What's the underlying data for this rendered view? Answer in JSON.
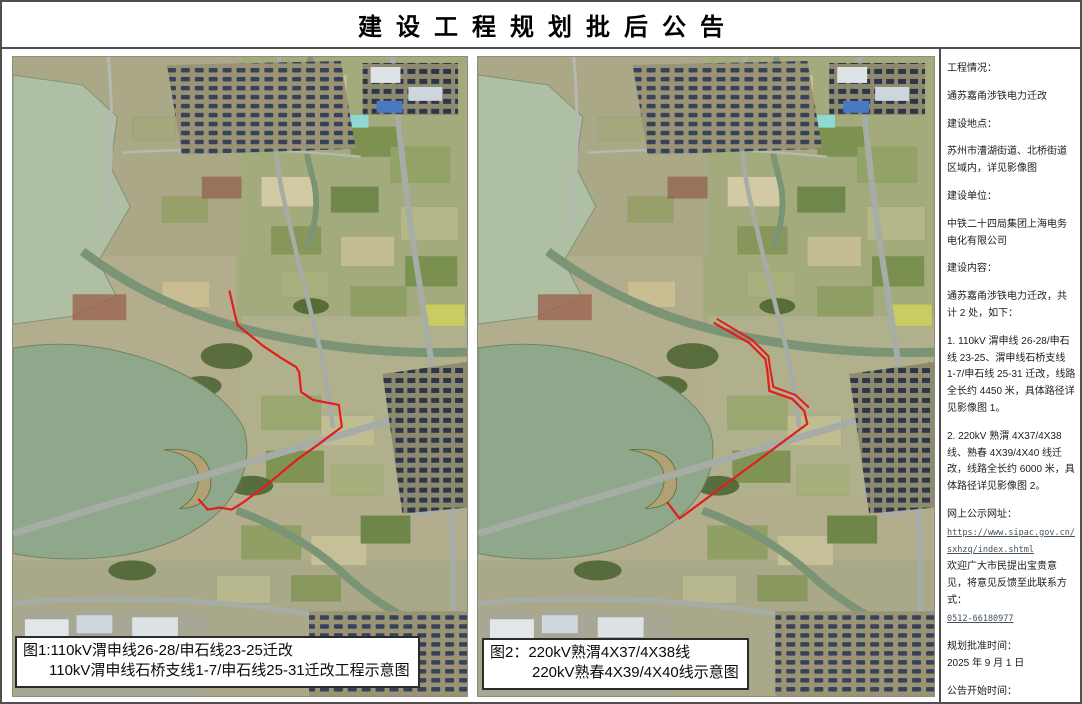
{
  "page": {
    "title": "建设工程规划批后公告"
  },
  "sidebar": {
    "items": [
      {
        "text": "工程情况："
      },
      {
        "text": "通苏嘉甬涉铁电力迁改"
      },
      {
        "text": "建设地点："
      },
      {
        "text": "苏州市漕湖街道、北桥街道区域内，详见影像图"
      },
      {
        "text": "建设单位："
      },
      {
        "text": "中铁二十四局集团上海电务电化有限公司"
      },
      {
        "text": "建设内容："
      },
      {
        "text": "通苏嘉甬涉铁电力迁改，共计 2 处，如下："
      },
      {
        "text": "1.  110kV 渭申线 26-28/申石线 23-25、渭申线石桥支线 1-7/申石线 25-31 迁改，线路全长约 4450 米，具体路径详见影像图 1。"
      },
      {
        "text": "2.  220kV 熟渭 4X37/4X38 线、熟春 4X39/4X40 线迁改，线路全长约 6000 米，具体路径详见影像图 2。"
      },
      {
        "text": "网上公示网址："
      },
      {
        "text": "https://www.sipac.gov.cn/sxhzq/index.shtml"
      },
      {
        "text": "欢迎广大市民提出宝贵意见，将意见反馈至此联系方式："
      },
      {
        "text": "0512-66180977"
      },
      {
        "text": "规划批准时间："
      },
      {
        "text": "2025 年 9 月 1 日"
      },
      {
        "text": "公告开始时间："
      },
      {
        "text": "2025 年 9 月 3 日"
      }
    ]
  },
  "maps": {
    "left": {
      "caption_line1": "图1:110kV渭申线26-28/申石线23-25迁改",
      "caption_line2": "110kV渭申线石桥支线1-7/申石线25-31迁改工程示意图"
    },
    "right": {
      "caption_line1": "图2：220kV熟渭4X37/4X38线",
      "caption_line2": "220kV熟春4X39/4X40线示意图"
    }
  },
  "colors": {
    "route_red": "#e51c1c",
    "page_border": "#4f4f4f",
    "link_text": "#45525c",
    "lake_green": "#8fa78b"
  }
}
